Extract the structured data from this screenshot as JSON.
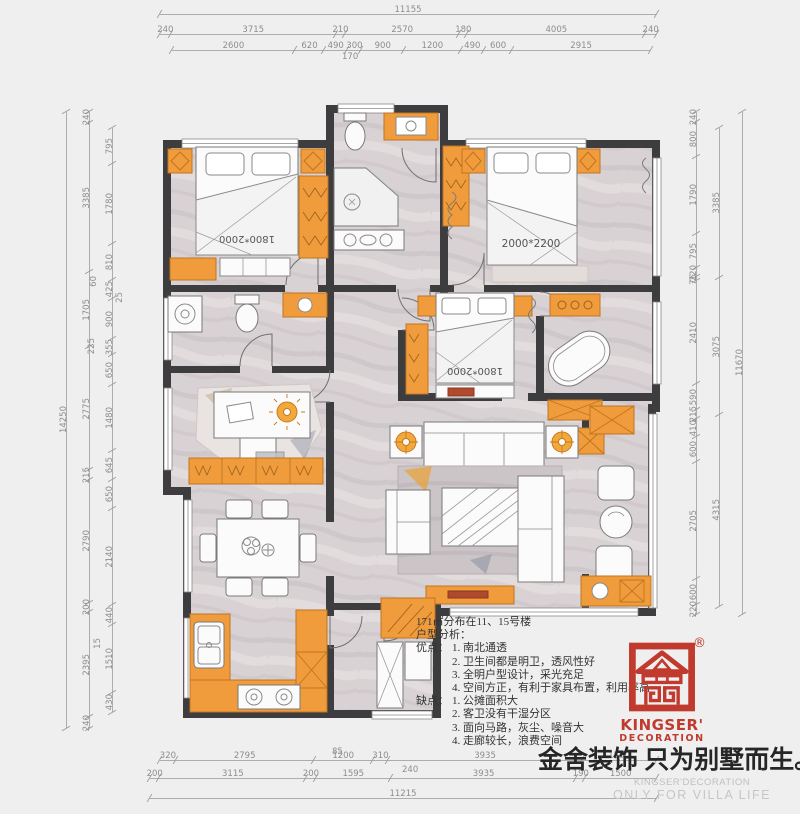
{
  "plan": {
    "bed_top_left_label": "1800*2000",
    "bed_top_right_label": "2000*2200",
    "bed_middle_label": "1800*2000"
  },
  "analysis": {
    "area_line": "171㎡分布在11、15号楼",
    "heading": "户型分析：",
    "pros_label": "优点：",
    "pros": [
      "1. 南北通透",
      "2. 卫生间都是明卫，透风性好",
      "3. 全明户型设计，采光充足",
      "4. 空间方正，有利于家具布置，利用率高"
    ],
    "cons_label": "缺点：",
    "cons": [
      "1. 公摊面积大",
      "2. 客卫没有干湿分区",
      "3. 面向马路，灰尘、噪音大",
      "4. 走廊较长，浪费空间"
    ]
  },
  "logo": {
    "registered": "®",
    "name_line1": "KINGSER'",
    "name_line2": "DECORATION",
    "brand_red": "#c13a2e"
  },
  "footer": {
    "slogan": "金舍装饰 只为别墅而生。",
    "watermark_line1": "KINGSER'DECORATION",
    "watermark_line2": "ONLY FOR VILLA LIFE"
  },
  "colors": {
    "wall": "#3d3d40",
    "furniture_orange": "#f09c3c",
    "floor_marble": "#d8d2d4",
    "dimension_gray": "#8d8d8d"
  },
  "dims": {
    "top": {
      "total": "11155",
      "row2": [
        "240",
        "3715",
        "210",
        "2570",
        "180",
        "4005",
        "240"
      ],
      "row3": [
        "2600",
        "620",
        "490",
        "300",
        "900",
        "1200",
        "490",
        "600",
        "2915"
      ],
      "callout_170": "170"
    },
    "left": {
      "total": "14250",
      "mid": [
        "240",
        "3385",
        "1705",
        "2775",
        "215",
        "2790",
        "200",
        "2395",
        "240"
      ],
      "inner": [
        "795",
        "1780",
        "810",
        "425",
        "900",
        "355",
        "650",
        "1480",
        "645",
        "650",
        "2140",
        "440",
        "1510",
        "430"
      ],
      "callouts": [
        "60",
        "25",
        "225",
        "15"
      ]
    },
    "right": {
      "total": "11670",
      "mid": [
        "3385",
        "3075",
        "4315"
      ],
      "inner": [
        "240",
        "800",
        "1790",
        "795",
        "220",
        "75",
        "2410",
        "590",
        "215",
        "410",
        "600",
        "2705",
        "600",
        "220"
      ]
    },
    "bottom": {
      "total": "11215",
      "row_upper": [
        "320",
        "2795",
        "1200",
        "310",
        "3935",
        "1500"
      ],
      "row_lower": [
        "200",
        "3115",
        "200",
        "1595",
        "3935",
        "190",
        "1500"
      ],
      "callouts": [
        "85",
        "240"
      ]
    }
  }
}
